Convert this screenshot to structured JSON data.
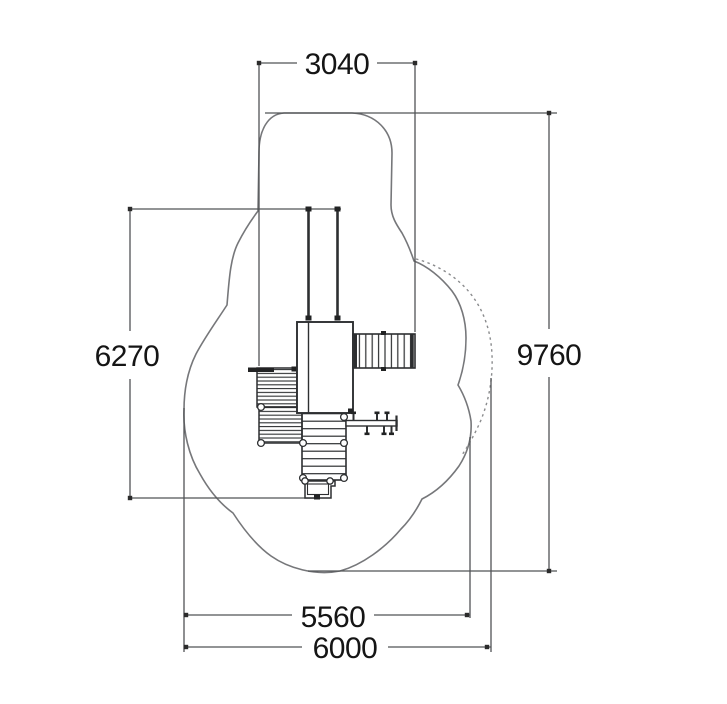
{
  "diagram": {
    "kind": "playground-equipment-plan-view",
    "labels": {
      "top_width": "3040",
      "left_height": "6270",
      "right_height": "9760",
      "bottom_inner_width": "5560",
      "bottom_total_width": "6000"
    },
    "colors": {
      "background": "#ffffff",
      "outline": "#76777a",
      "outline_dashed": "#8a8b8d",
      "dimension_line": "#515356",
      "structure_line": "#2d2f31",
      "text": "#151515"
    }
  }
}
